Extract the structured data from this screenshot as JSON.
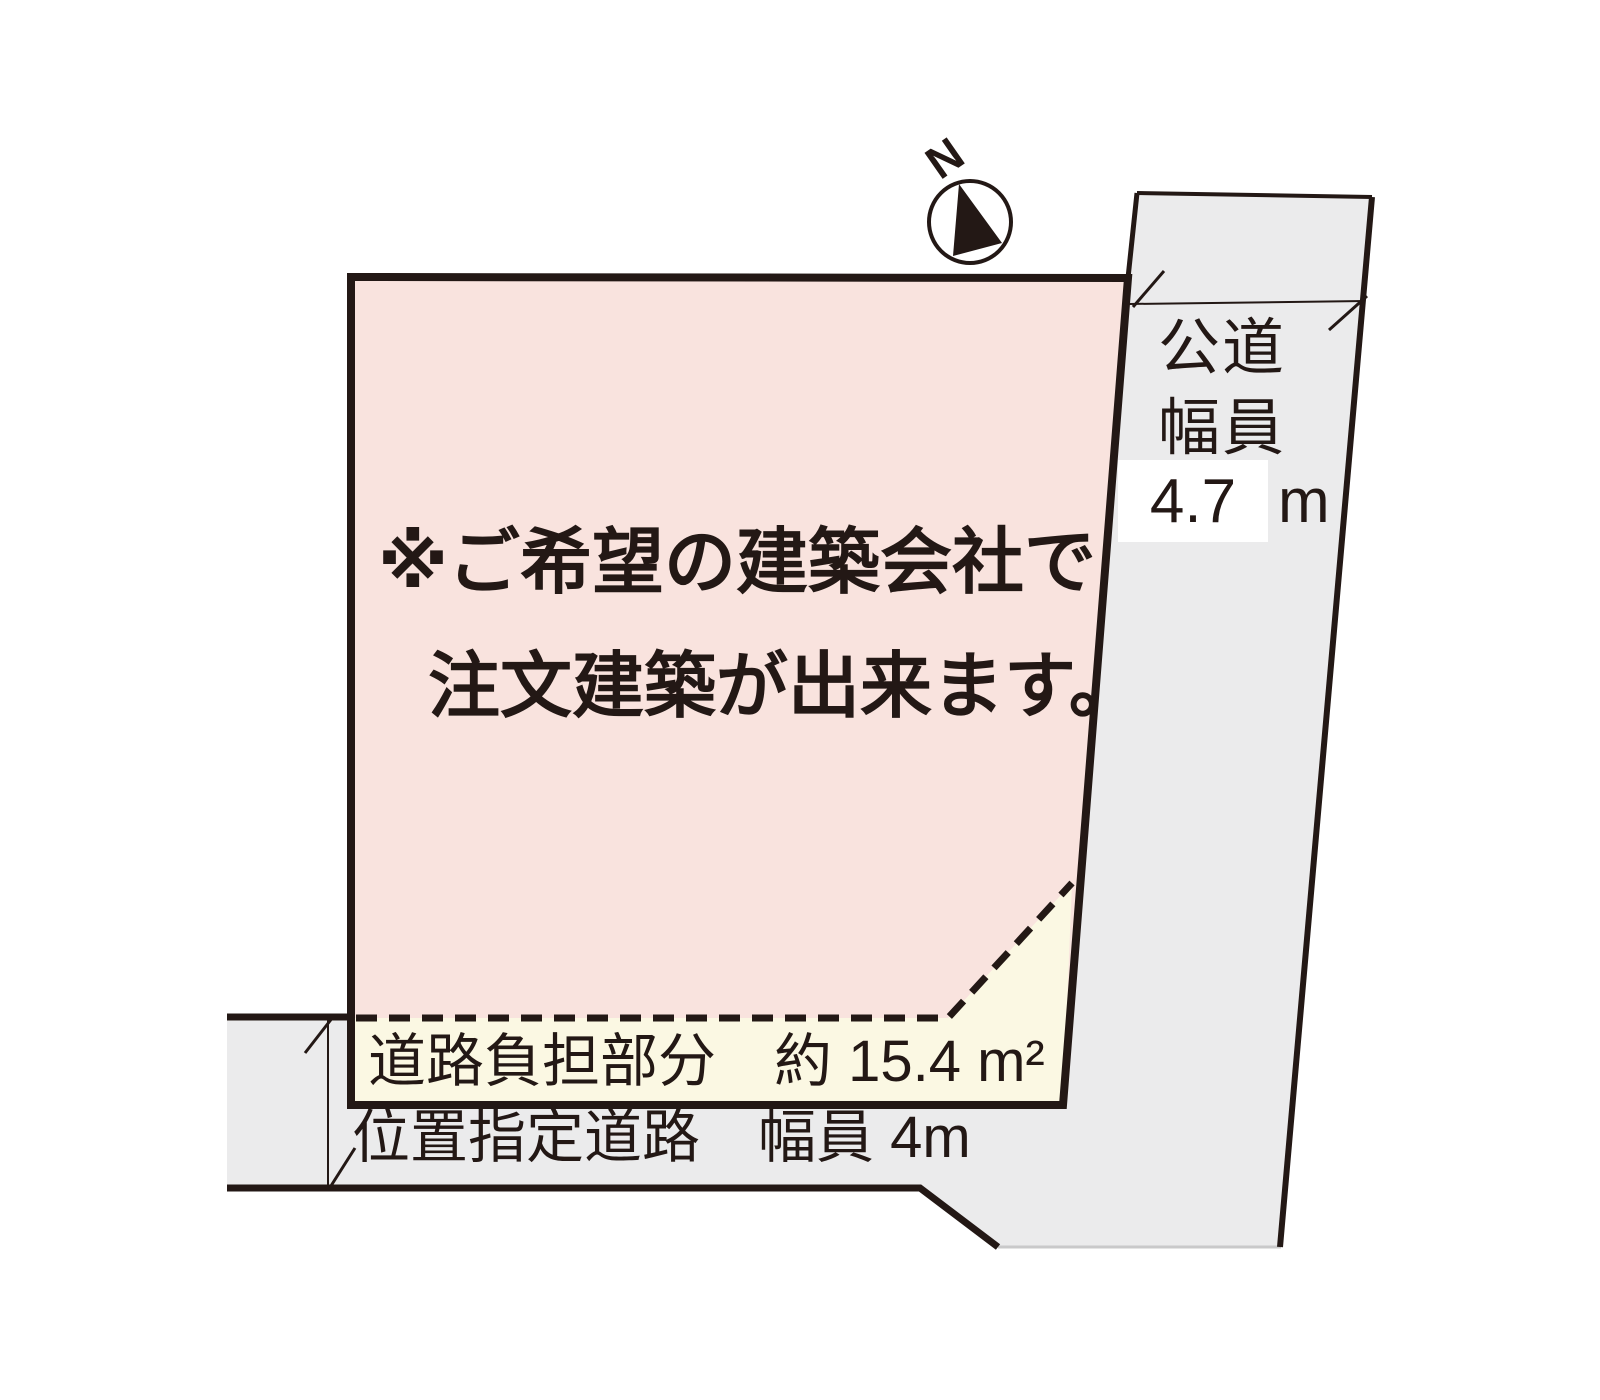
{
  "title": "土地区画図",
  "colors": {
    "site_fill": "#f9e3de",
    "burden_fill": "#fbf8e3",
    "road_fill": "#ebebec",
    "line": "#231815",
    "value_box_bg": "#ffffff"
  },
  "compass": {
    "label": "N"
  },
  "site": {
    "note_line1": "※ご希望の建築会社で",
    "note_line2": "注文建築が出来ます。"
  },
  "burden_strip": {
    "label": "道路負担部分　約 15.4 m²",
    "area_value": "約 15.4 m²"
  },
  "bottom_road": {
    "label": "位置指定道路　幅員 4m",
    "width_value": "4m"
  },
  "public_road": {
    "name_line1": "公道",
    "name_line2": "幅員",
    "width_value": "4.7",
    "width_unit": "m"
  }
}
